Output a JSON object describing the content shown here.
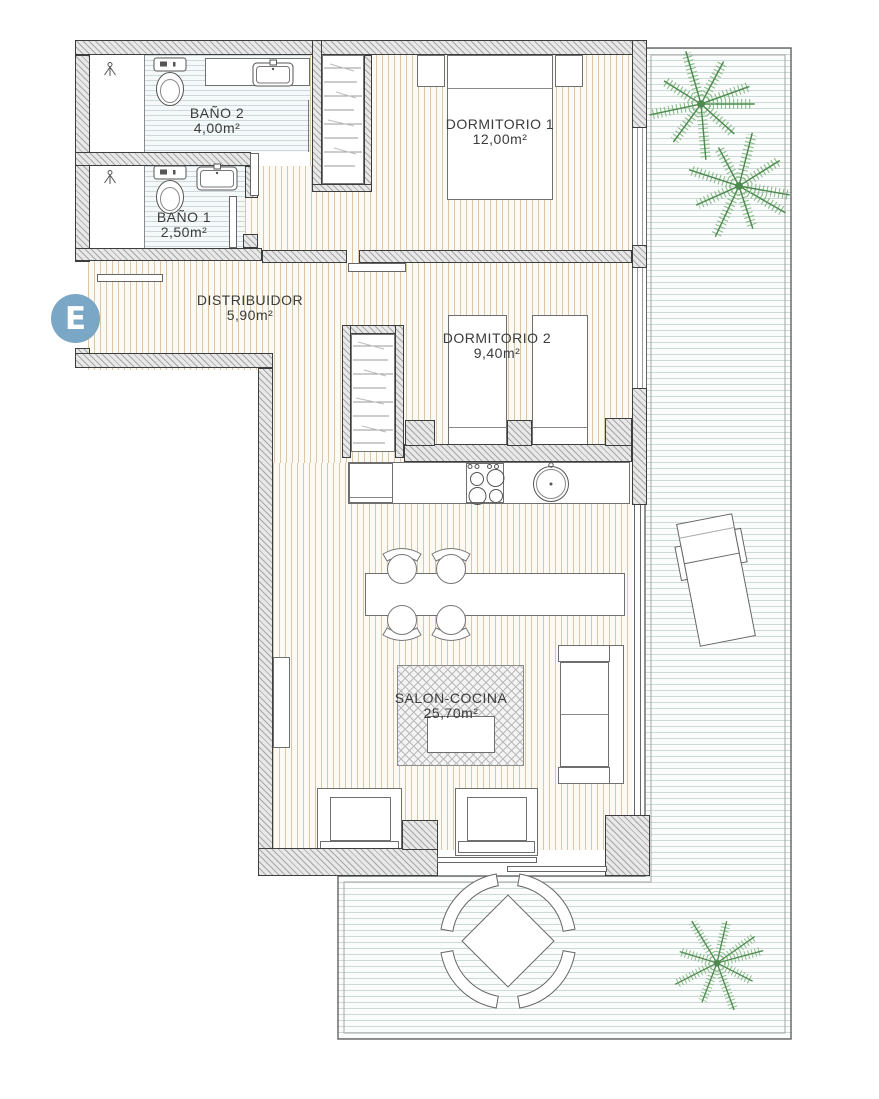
{
  "floorplan": {
    "title": "Apartment floor plan with terrace",
    "entrance": {
      "label": "E"
    },
    "rooms": [
      {
        "id": "bano2",
        "name": "BAÑO 2",
        "area": "4,00m²"
      },
      {
        "id": "bano1",
        "name": "BAÑO 1",
        "area": "2,50m²"
      },
      {
        "id": "dormitorio1",
        "name": "DORMITORIO 1",
        "area": "12,00m²"
      },
      {
        "id": "distribuidor",
        "name": "DISTRIBUIDOR",
        "area": "5,90m²"
      },
      {
        "id": "dormitorio2",
        "name": "DORMITORIO 2",
        "area": "9,40m²"
      },
      {
        "id": "salon_cocina",
        "name": "SALON-COCINA",
        "area": "25,70m²"
      }
    ],
    "icons": [
      "toilet",
      "bathroom-sink",
      "shower-head",
      "wardrobe-hangers",
      "double-bed",
      "single-bed",
      "nightstand",
      "fridge",
      "cooktop",
      "kitchen-sink",
      "dining-table",
      "dining-chair",
      "rug",
      "coffee-table",
      "sofa",
      "armchair",
      "sideboard",
      "sliding-door",
      "window",
      "door-leaf",
      "palm-tree",
      "sun-lounger",
      "outdoor-table",
      "outdoor-chair"
    ],
    "colors": {
      "entrance_badge": "#7ba7c7",
      "palm_green": "#8cbd8c",
      "palm_stem": "#4d8a4d",
      "wood_stripe": "#dbc7a7",
      "bath_stripe": "#ccd8dc",
      "deck_stripe": "#cdd9d7",
      "wall_edge": "#3d3d3d",
      "label_text": "#3b3b3b"
    }
  }
}
